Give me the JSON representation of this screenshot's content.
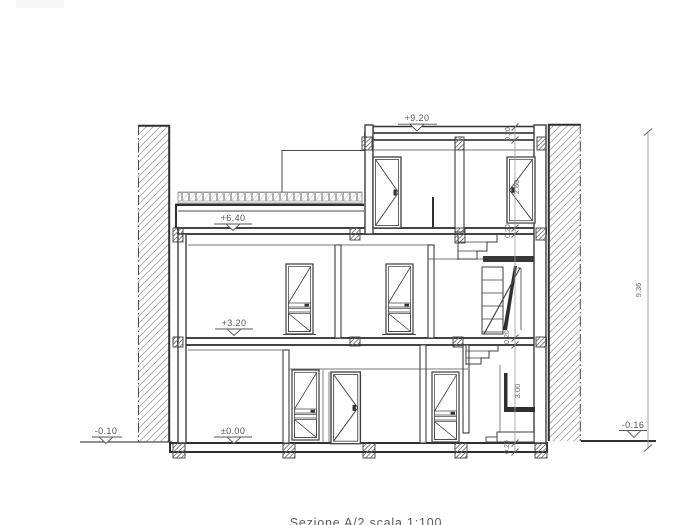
{
  "drawing": {
    "caption": "Sezione A/2 scala 1:100",
    "levels": {
      "roof": "+9.20",
      "second": "+6.40",
      "first": "+3.20",
      "ground": "±0.00",
      "grade_left": "-0.10",
      "grade_right": "-0.16"
    },
    "dimensions": {
      "roof_slab": "0.20",
      "penthouse_height": "2.60",
      "mid_slab": "0.20",
      "first_slab": "0.20",
      "ground_height": "3.00",
      "bottom_slab": "0.20",
      "total_height": "9.36"
    },
    "colors": {
      "line": "#3d3d3d",
      "dim": "#8a8a8a",
      "text": "#555555",
      "hatch": "#a8a8a8"
    }
  }
}
